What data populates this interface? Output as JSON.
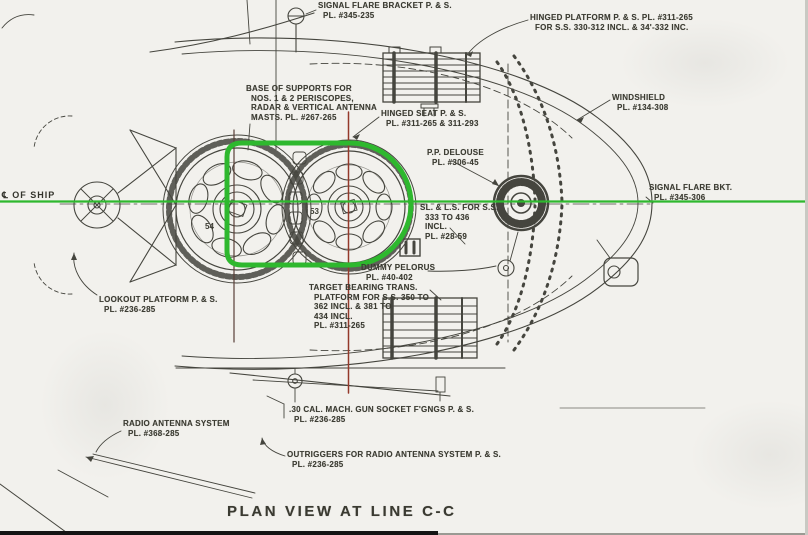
{
  "drawing": {
    "title": "PLAN VIEW AT LINE C-C",
    "centerline_label": "℄ OF SHIP",
    "colors": {
      "paper": "#f2f1ed",
      "ink": "#45453e",
      "highlight_green": "#2eb82e",
      "reference_red": "#94392a"
    },
    "part_numbers": {
      "left_mount": "54",
      "right_mount": "53"
    },
    "labels": [
      {
        "id": "signal-flare-bracket-top",
        "x": 318,
        "y": 1,
        "lines": [
          "SIGNAL FLARE BRACKET P. & S.",
          "PL. #345-235"
        ]
      },
      {
        "id": "hinged-platform",
        "x": 530,
        "y": 13,
        "lines": [
          "HINGED PLATFORM P. & S. PL. #311-265",
          "FOR S.S. 330-312 INCL. & 34'-332 INC."
        ]
      },
      {
        "id": "windshield",
        "x": 612,
        "y": 93,
        "lines": [
          "WINDSHIELD",
          "PL. #134-308"
        ]
      },
      {
        "id": "base-of-supports",
        "x": 246,
        "y": 84,
        "lines": [
          "BASE OF SUPPORTS FOR",
          "NOS. 1 & 2 PERISCOPES,",
          "RADAR & VERTICAL ANTENNA",
          "MASTS. PL. #267-265"
        ]
      },
      {
        "id": "hinged-seat",
        "x": 381,
        "y": 109,
        "lines": [
          "HINGED SEAT P. & S.",
          "PL. #311-265 & 311-293"
        ]
      },
      {
        "id": "pp-delouse",
        "x": 427,
        "y": 148,
        "lines": [
          "P.P. DELOUSE",
          "PL. #306-45"
        ]
      },
      {
        "id": "signal-flare-bkt-right",
        "x": 649,
        "y": 183,
        "lines": [
          "SIGNAL FLARE BKT.",
          "PL. #345-306"
        ]
      },
      {
        "id": "sl-ls-for-ss",
        "x": 420,
        "y": 203,
        "lines": [
          "SL. & L.S. FOR S.S.",
          "333 TO 436",
          "INCL.",
          "PL. #28-59"
        ]
      },
      {
        "id": "dummy-pelorus",
        "x": 361,
        "y": 263,
        "lines": [
          "DUMMY PELORUS",
          "PL. #40-402"
        ]
      },
      {
        "id": "target-bearing-trans",
        "x": 309,
        "y": 283,
        "lines": [
          "TARGET BEARING TRANS.",
          "PLATFORM FOR S.S. 350 TO",
          "362 INCL. & 381 TO",
          "434 INCL.",
          "PL. #311-265"
        ]
      },
      {
        "id": "lookout-platform",
        "x": 99,
        "y": 295,
        "lines": [
          "LOOKOUT PLATFORM P. & S.",
          "PL. #236-285"
        ]
      },
      {
        "id": "mg-socket",
        "x": 289,
        "y": 405,
        "lines": [
          ".30 CAL. MACH. GUN SOCKET F'GNGS P. & S.",
          "PL. #236-285"
        ]
      },
      {
        "id": "radio-antenna-system",
        "x": 123,
        "y": 419,
        "lines": [
          "RADIO ANTENNA SYSTEM",
          "PL. #368-285"
        ]
      },
      {
        "id": "outriggers",
        "x": 287,
        "y": 450,
        "lines": [
          "OUTRIGGERS FOR RADIO ANTENNA SYSTEM P. & S.",
          "PL. #236-285"
        ]
      }
    ]
  }
}
